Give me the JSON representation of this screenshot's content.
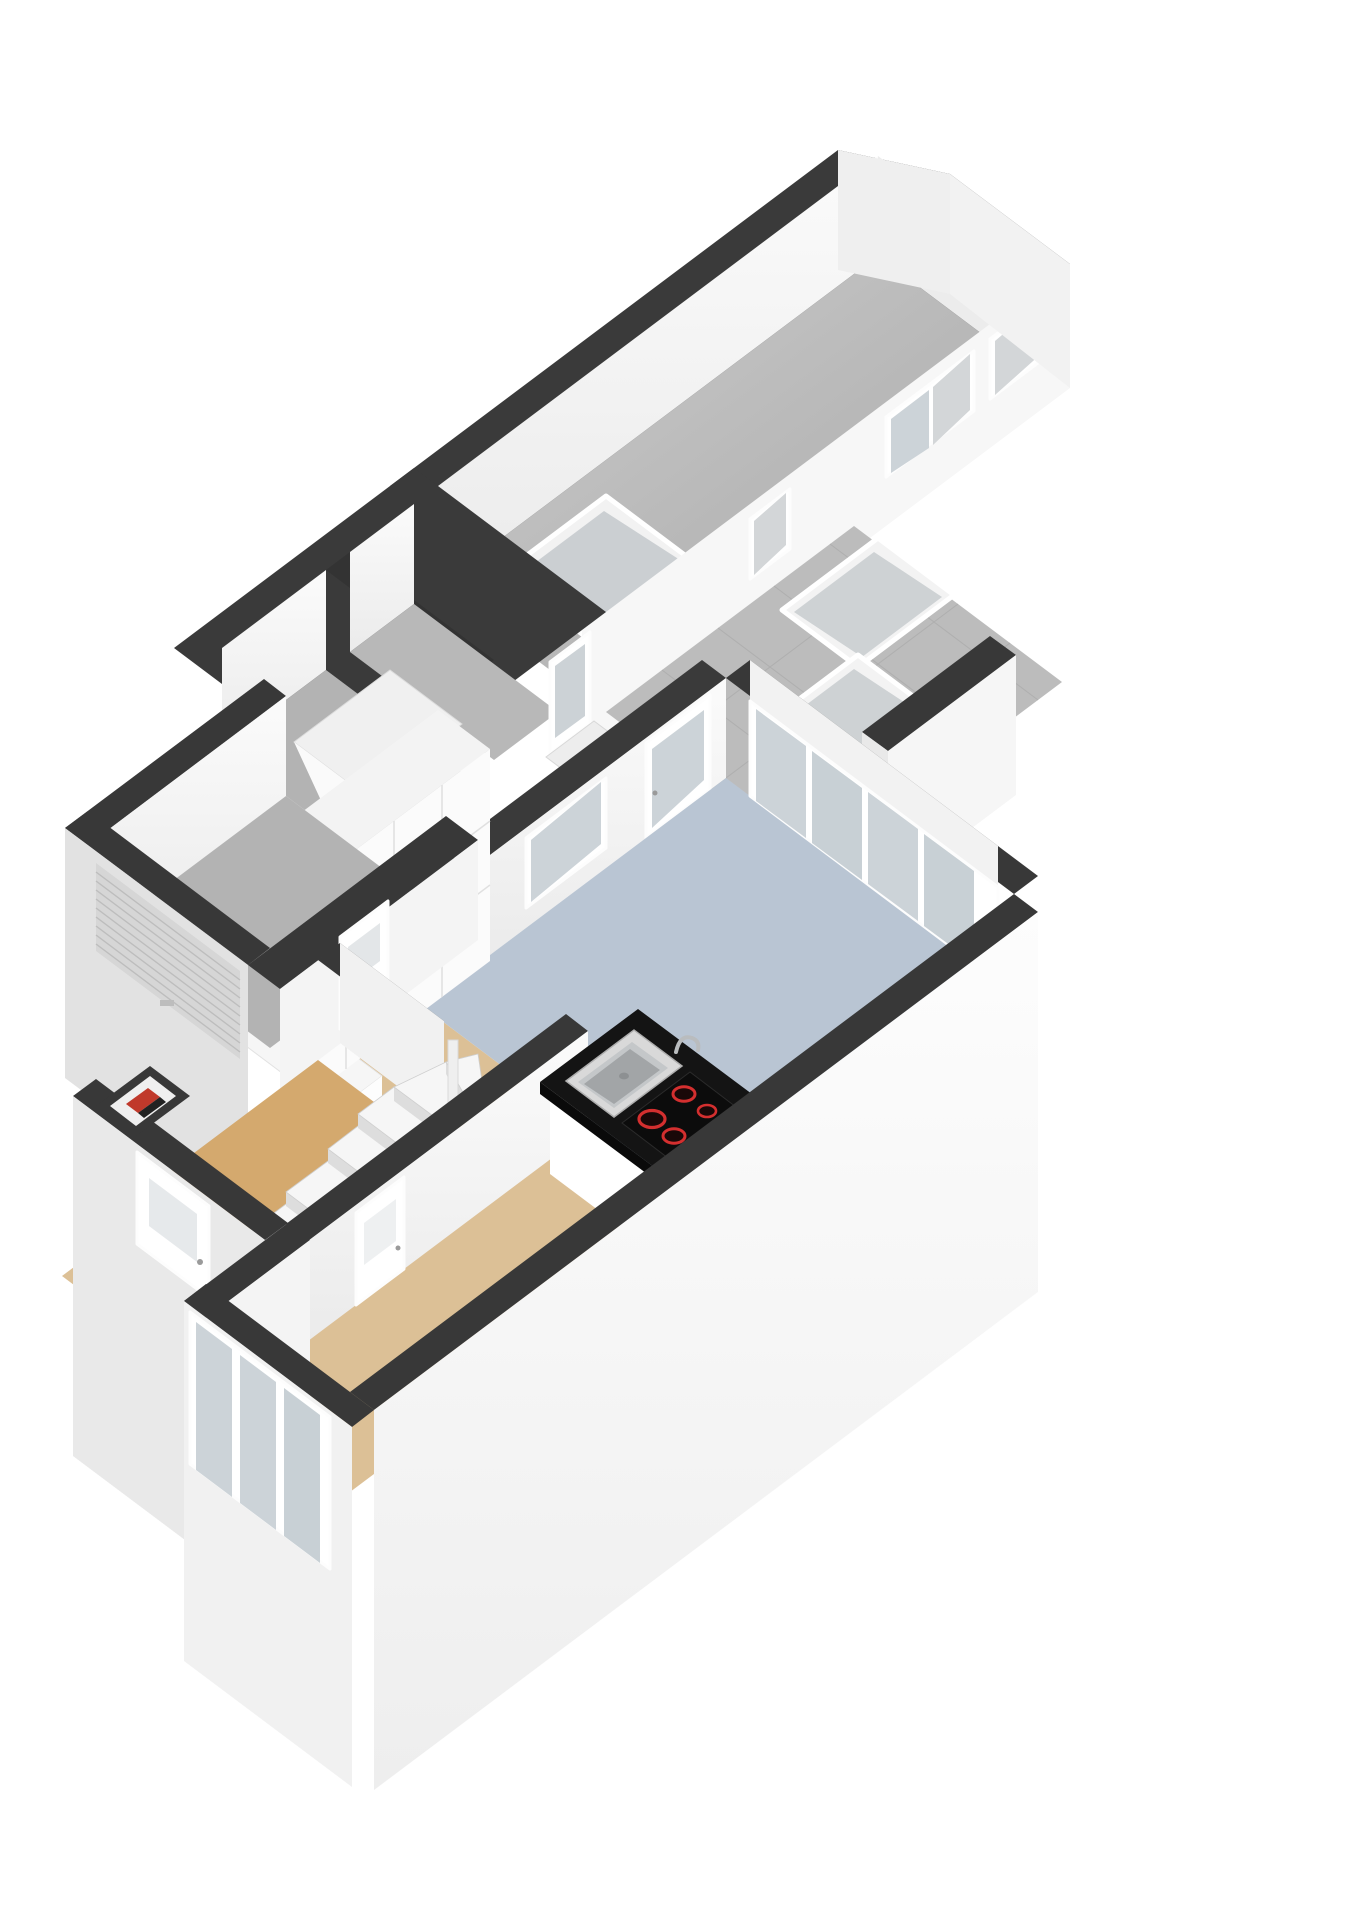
{
  "scene": {
    "type": "3d-floorplan-isometric",
    "view": "ground-floor cutaway, walls cut dark on top",
    "background": "#ffffff"
  },
  "colors": {
    "wall_top": "#3a3a3a",
    "wall_face": "#f7f7f7",
    "wall_face_shaded": "#e9e9e9",
    "wall_exterior": "#e2e2e2",
    "floor_gray": "#b3b3b3",
    "floor_gray_light": "#c9c9c9",
    "floor_blue": "#b9c5d3",
    "floor_tan": "#dcc096",
    "floor_stairs_tan": "#d4a96e",
    "patio_tiles": "#bcbcbc",
    "glass": "#ccd3d8",
    "skylight_glass": "#c7cbce",
    "island_black": "#141414",
    "hob_black": "#0c0c0c",
    "burner_red": "#d42f2f",
    "oven_black": "#161616",
    "boiler_red": "#c0392b",
    "door_white": "#fbfbfb",
    "cabinet_white": "#fbfbfb",
    "garage_door_gray": "#d6d6d6",
    "sink_steel": "#c4c7c9"
  },
  "rooms": [
    {
      "name": "storage-annex",
      "floor": "gray concrete"
    },
    {
      "name": "patio-terrace",
      "floor": "gray tiles with three flat skylights"
    },
    {
      "name": "kitchen",
      "floor": "blue-gray"
    },
    {
      "name": "living-room",
      "floor": "tan wood"
    },
    {
      "name": "stair-hall",
      "floor": "tan wood"
    },
    {
      "name": "garage",
      "floor": "gray"
    },
    {
      "name": "storage-room-a",
      "floor": "gray"
    },
    {
      "name": "storage-room-b",
      "floor": "gray"
    }
  ],
  "features": {
    "annex_windows": 3,
    "annex_floor_skylight": 1,
    "patio_skylights": 3,
    "facade_window_panes": 3,
    "folding_glass_door_panels": 4,
    "built_in_ovens": 2,
    "hob_burners": 4,
    "island": "black worktop with steel sink, faucet and induction hob",
    "staircase": "winder stairs turning around newel",
    "garage_door": "roller door with horizontal slats",
    "front_door": "white with frosted pane",
    "back_door": "glazed",
    "meter_cupboard": "small niche with red boiler unit"
  }
}
